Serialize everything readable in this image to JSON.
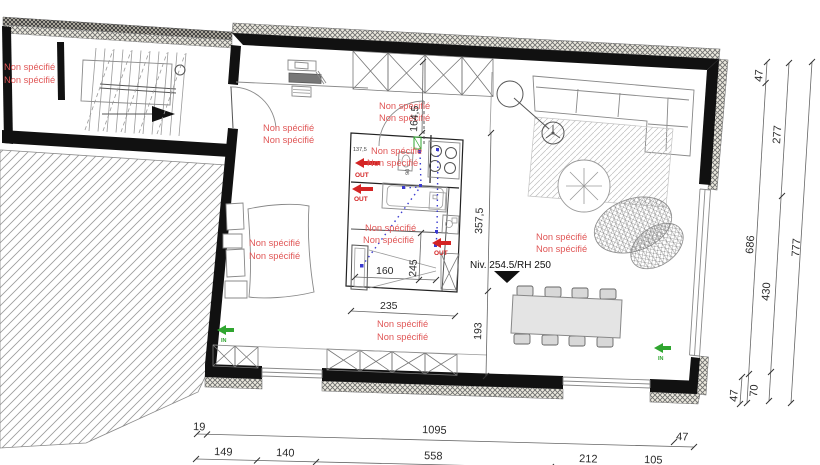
{
  "t": {
    "unspec": "Non spécifié",
    "level": "Niv. 254.5/RH 250",
    "out": "OUT",
    "in": "IN"
  },
  "dims": {
    "a164": "164,5",
    "a137": "137,5",
    "a90": "90",
    "a357": "357,5",
    "a193": "193",
    "a160": "160",
    "a235": "235",
    "a245": "245",
    "right": {
      "r47t": "47",
      "r277": "277",
      "r686": "686",
      "r430": "430",
      "r777": "777",
      "r70": "70",
      "r47b": "47"
    },
    "bottom": {
      "b19": "19",
      "b1095": "1095",
      "b47": "47",
      "b149": "149",
      "b140": "140",
      "b558": "558",
      "b212": "212",
      "b105": "105"
    }
  },
  "colors": {
    "red_text": "#e05656",
    "out_arrow": "#d42424",
    "in_arrow": "#2fa52f",
    "wall": "#111111",
    "plumbing": "#3a3ad0"
  }
}
